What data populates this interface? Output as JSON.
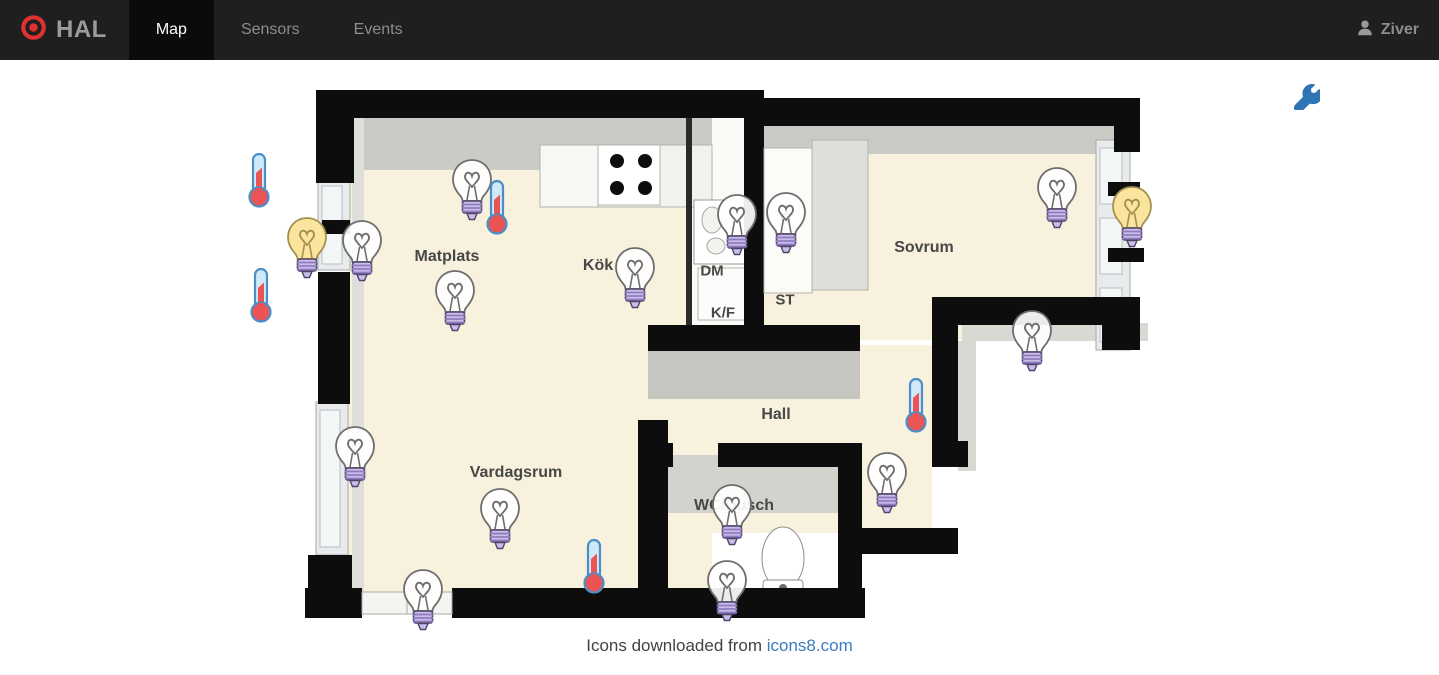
{
  "navbar": {
    "brand": "HAL",
    "tabs": [
      {
        "label": "Map",
        "active": true
      },
      {
        "label": "Sensors",
        "active": false
      },
      {
        "label": "Events",
        "active": false
      }
    ],
    "user": "Ziver"
  },
  "map": {
    "settings_icon": "wrench-icon",
    "rooms": [
      {
        "name": "Matplats",
        "x": 447,
        "y": 197
      },
      {
        "name": "Kök",
        "x": 598,
        "y": 206
      },
      {
        "name": "DM",
        "x": 712,
        "y": 211,
        "small": true
      },
      {
        "name": "K/F",
        "x": 723,
        "y": 253,
        "small": true
      },
      {
        "name": "G",
        "x": 786,
        "y": 158,
        "small": true
      },
      {
        "name": "ST",
        "x": 785,
        "y": 240,
        "small": true
      },
      {
        "name": "Sovrum",
        "x": 924,
        "y": 188
      },
      {
        "name": "Hall",
        "x": 776,
        "y": 355
      },
      {
        "name": "Vardagsrum",
        "x": 516,
        "y": 413
      },
      {
        "name": "WC/Dusch",
        "x": 734,
        "y": 446
      }
    ],
    "devices": [
      {
        "type": "light",
        "state": "on",
        "x": 307,
        "y": 181
      },
      {
        "type": "light",
        "state": "off",
        "x": 362,
        "y": 184
      },
      {
        "type": "light",
        "state": "off",
        "x": 472,
        "y": 123
      },
      {
        "type": "light",
        "state": "off",
        "x": 455,
        "y": 234
      },
      {
        "type": "light",
        "state": "off",
        "x": 635,
        "y": 211
      },
      {
        "type": "light",
        "state": "off",
        "x": 737,
        "y": 158
      },
      {
        "type": "light",
        "state": "off",
        "x": 786,
        "y": 156
      },
      {
        "type": "light",
        "state": "off",
        "x": 1057,
        "y": 131
      },
      {
        "type": "light",
        "state": "on",
        "x": 1132,
        "y": 150
      },
      {
        "type": "light",
        "state": "off",
        "x": 1032,
        "y": 274
      },
      {
        "type": "light",
        "state": "off",
        "x": 887,
        "y": 416
      },
      {
        "type": "light",
        "state": "off",
        "x": 355,
        "y": 390
      },
      {
        "type": "light",
        "state": "off",
        "x": 500,
        "y": 452
      },
      {
        "type": "light",
        "state": "off",
        "x": 423,
        "y": 533
      },
      {
        "type": "light",
        "state": "off",
        "x": 732,
        "y": 448
      },
      {
        "type": "light",
        "state": "off",
        "x": 727,
        "y": 524
      },
      {
        "type": "thermometer",
        "x": 259,
        "y": 120
      },
      {
        "type": "thermometer",
        "x": 261,
        "y": 235
      },
      {
        "type": "thermometer",
        "x": 497,
        "y": 147
      },
      {
        "type": "thermometer",
        "x": 916,
        "y": 345
      },
      {
        "type": "thermometer",
        "x": 594,
        "y": 506
      }
    ]
  },
  "footer": {
    "text": "Icons downloaded from ",
    "link": "icons8.com"
  },
  "colors": {
    "brand_red": "#e03131",
    "accent_blue": "#2e75b6",
    "light_on_fill": "#fbe49e",
    "light_on_stroke": "#a3914f",
    "light_off_stroke": "#6e6e6e",
    "bulb_base": "#cabdea",
    "bulb_base_stripe": "#8f7cc0",
    "bulb_base_stroke": "#4d4468",
    "thermo_red": "#ea5455",
    "thermo_blue": "#cfe9f8",
    "thermo_outline": "#4a8fc7",
    "wall": "#0d0d0d",
    "wall_face": "#cbcbc6",
    "floor": "#f8f1dd"
  }
}
